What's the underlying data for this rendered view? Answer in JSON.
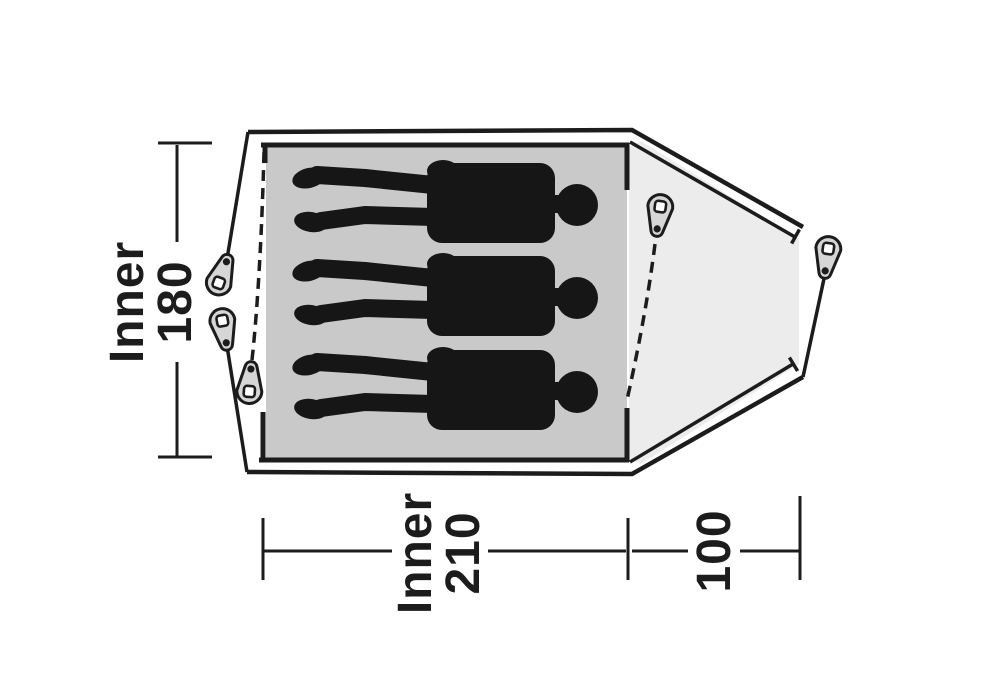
{
  "diagram": {
    "type": "tent-floorplan-top-view",
    "sleeping_capacity": 3,
    "dimensions": {
      "inner_width": {
        "word": "Inner",
        "value": "180"
      },
      "inner_length": {
        "word": "Inner",
        "value": "210"
      },
      "porch_depth": {
        "value": "100"
      }
    },
    "colors": {
      "line": "#1c1c1c",
      "inner_area": "#c9c9c9",
      "porch_area": "#ececec",
      "peg_fill": "#d6d6d6",
      "silhouette": "#161616",
      "background": "#ffffff"
    }
  }
}
